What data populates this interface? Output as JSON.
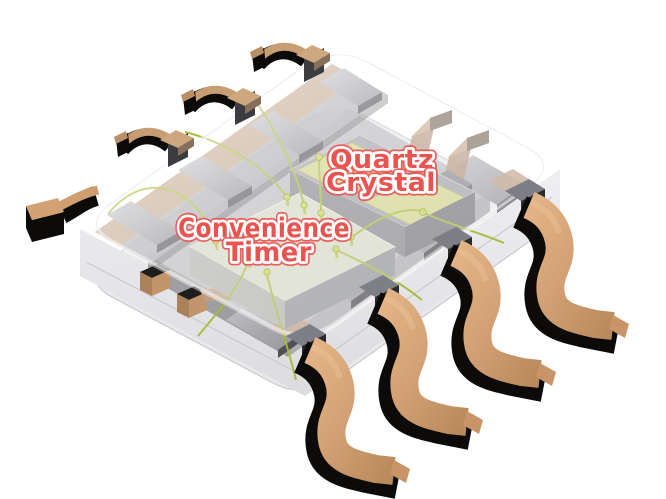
{
  "scene": {
    "type": "3d-cutaway-illustration",
    "subject": "Translucent SOIC-8 integrated circuit package revealing internal leadframe, timer die and quartz crystal"
  },
  "labels": {
    "crystal": {
      "line1": "Quartz",
      "line2": "Crystal"
    },
    "timer": {
      "line1": "Convenience",
      "line2": "Timer"
    }
  },
  "components": {
    "crystal_name": "Quartz Crystal",
    "die_name": "Convenience Timer",
    "front_leads_visible": 4,
    "back_leads_visible": 4
  },
  "theme": {
    "background_color": "#ffffff",
    "label_text_color": "#e95450",
    "label_outline_color": "#ffffff",
    "copper_color": "#d2a074",
    "copper_highlight_color": "#e3b486",
    "copper_shadow_color": "#0d0b09",
    "muted_copper_color": "#bb9c80",
    "leadframe_gray": "#a6a6ab",
    "package_body_color": "#e9e9ec",
    "die_color": "#d6d8c7",
    "crystal_body_color": "#a4a4a9",
    "crystal_pad_color": "#d2d48f",
    "bond_wire_color": "#a8b93a"
  }
}
